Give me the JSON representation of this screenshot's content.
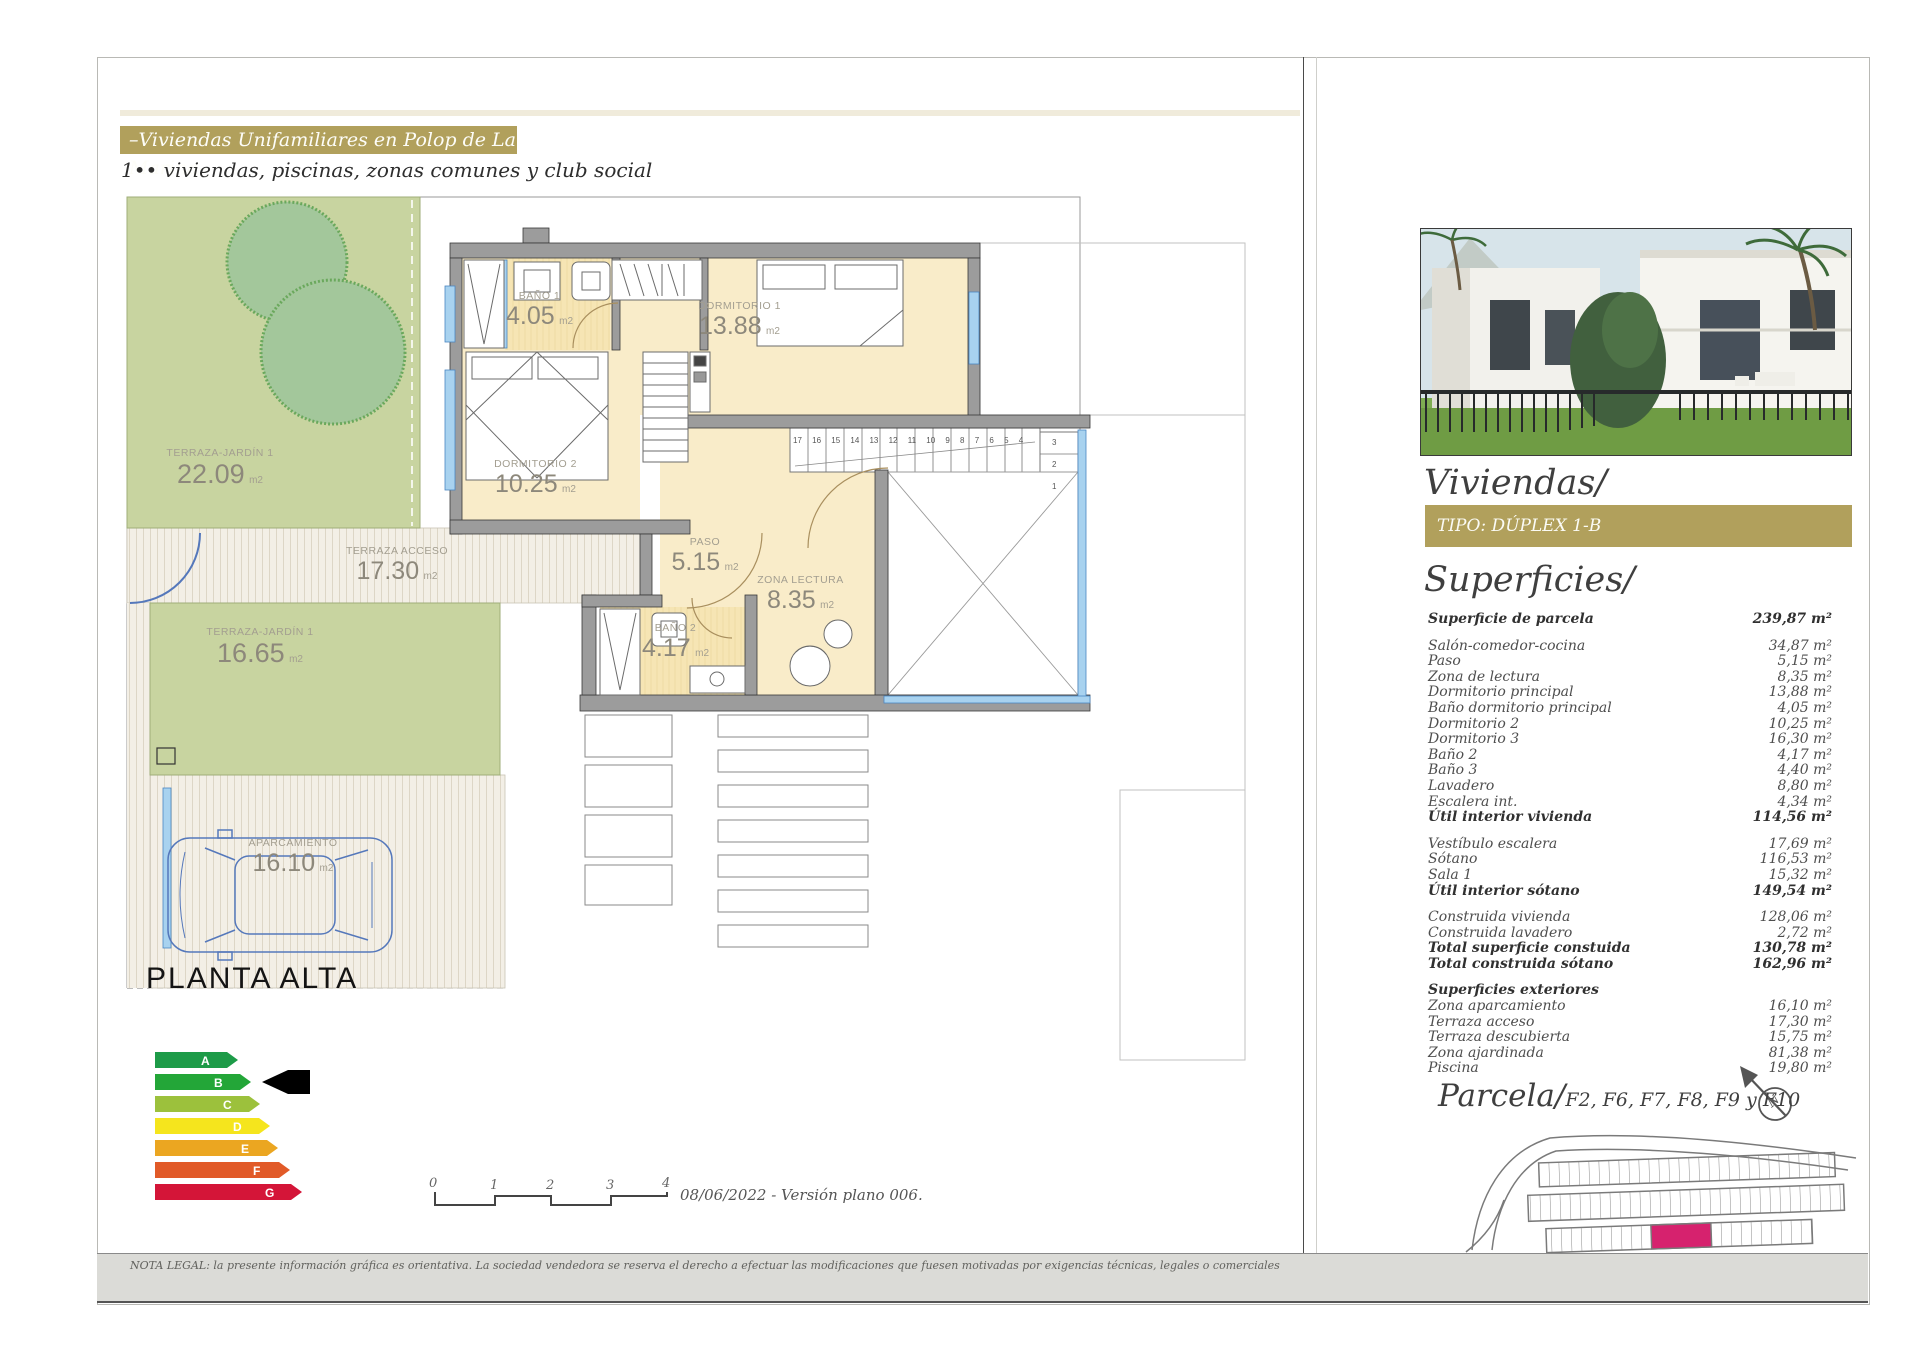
{
  "header": {
    "title": "–Viviendas Unifamiliares en Polop de La Marina–",
    "subtitle": "1•• viviendas, piscinas, zonas comunes y club social"
  },
  "colors": {
    "gold": "#b1a05c",
    "room_beige": "#f9ecc9",
    "garden_green": "#c8d4a0",
    "window_blue": "#a8d2ef",
    "car_blue": "#5578bb",
    "parcel_pink": "#d6226e"
  },
  "plan": {
    "title": "PLANTA ALTA",
    "rooms": {
      "garden1": {
        "n": "TERRAZA-JARDÍN 1",
        "v": "22.09",
        "u": "m2"
      },
      "acceso": {
        "n": "TERRAZA ACCESO",
        "v": "17.30",
        "u": "m2"
      },
      "garden2": {
        "n": "TERRAZA-JARDÍN 1",
        "v": "16.65",
        "u": "m2"
      },
      "aparc": {
        "n": "APARCAMIENTO",
        "v": "16.10",
        "u": "m2"
      },
      "bano1": {
        "n": "BAÑO 1",
        "v": "4.05",
        "u": "m2"
      },
      "dorm1": {
        "n": "DORMITORIO 1",
        "v": "13.88",
        "u": "m2"
      },
      "dorm2": {
        "n": "DORMITORIO 2",
        "v": "10.25",
        "u": "m2"
      },
      "paso": {
        "n": "PASO",
        "v": "5.15",
        "u": "m2"
      },
      "zona": {
        "n": "ZONA LECTURA",
        "v": "8.35",
        "u": "m2"
      },
      "bano2": {
        "n": "BAÑO 2",
        "v": "4.17",
        "u": "m2"
      }
    },
    "stairs": {
      "run": "17 16 15 14 13 12 11 10 9 8 7 6 5 4",
      "side": [
        "3",
        "2",
        "1"
      ]
    }
  },
  "energy": {
    "levels": [
      "A",
      "B",
      "C",
      "D",
      "E",
      "F",
      "G"
    ],
    "colors": [
      "#1d9b48",
      "#23a638",
      "#9cc13c",
      "#f5e51d",
      "#eba621",
      "#e15a28",
      "#d41538"
    ],
    "selected": "B"
  },
  "scale": {
    "ticks": [
      "0",
      "1",
      "2",
      "3",
      "4"
    ],
    "caption": "08/06/2022 - Versión plano 006."
  },
  "sidebar": {
    "heading": "Viviendas/",
    "type_label": "TIPO: DÚPLEX 1-B",
    "surfaces_heading": "Superficies/",
    "rows": [
      {
        "l": "Superficie de parcela",
        "v": "239,87 m²"
      },
      {
        "l": "Salón-comedor-cocina",
        "v": "34,87 m²"
      },
      {
        "l": "Paso",
        "v": "5,15 m²"
      },
      {
        "l": "Zona de lectura",
        "v": "8,35 m²"
      },
      {
        "l": "Dormitorio principal",
        "v": "13,88 m²"
      },
      {
        "l": "Baño dormitorio principal",
        "v": "4,05 m²"
      },
      {
        "l": "Dormitorio 2",
        "v": "10,25 m²"
      },
      {
        "l": "Dormitorio 3",
        "v": "16,30 m²"
      },
      {
        "l": "Baño 2",
        "v": "4,17 m²"
      },
      {
        "l": "Baño 3",
        "v": "4,40 m²"
      },
      {
        "l": "Lavadero",
        "v": "8,80 m²"
      },
      {
        "l": "Escalera int.",
        "v": "4,34 m²"
      },
      {
        "l": "Útil interior vivienda",
        "v": "114,56 m²"
      },
      {
        "l": "Vestíbulo escalera",
        "v": "17,69 m²"
      },
      {
        "l": "Sótano",
        "v": "116,53 m²"
      },
      {
        "l": "Sala 1",
        "v": "15,32 m²"
      },
      {
        "l": "Útil interior sótano",
        "v": "149,54 m²"
      },
      {
        "l": "Construida vivienda",
        "v": "128,06 m²"
      },
      {
        "l": "Construida lavadero",
        "v": "2,72 m²"
      },
      {
        "l": "Total superficie constuida",
        "v": "130,78 m²"
      },
      {
        "l": "Total construida sótano",
        "v": "162,96 m²"
      },
      {
        "l": "Superficies exteriores",
        "v": ""
      },
      {
        "l": "Zona aparcamiento",
        "v": "16,10 m²"
      },
      {
        "l": "Terraza acceso",
        "v": "17,30 m²"
      },
      {
        "l": "Terraza descubierta",
        "v": "15,75 m²"
      },
      {
        "l": "Zona ajardinada",
        "v": "81,38 m²"
      },
      {
        "l": "Piscina",
        "v": "19,80 m²"
      }
    ],
    "parcela_heading": "Parcela/",
    "parcela_codes": "F2, F6, F7, F8, F9 y F10",
    "compass_n": "N"
  },
  "footer": {
    "legal": "NOTA LEGAL: la presente información gráfica es orientativa. La sociedad vendedora se reserva el derecho a efectuar las modificaciones que fuesen motivadas por exigencias técnicas, legales o comerciales"
  }
}
